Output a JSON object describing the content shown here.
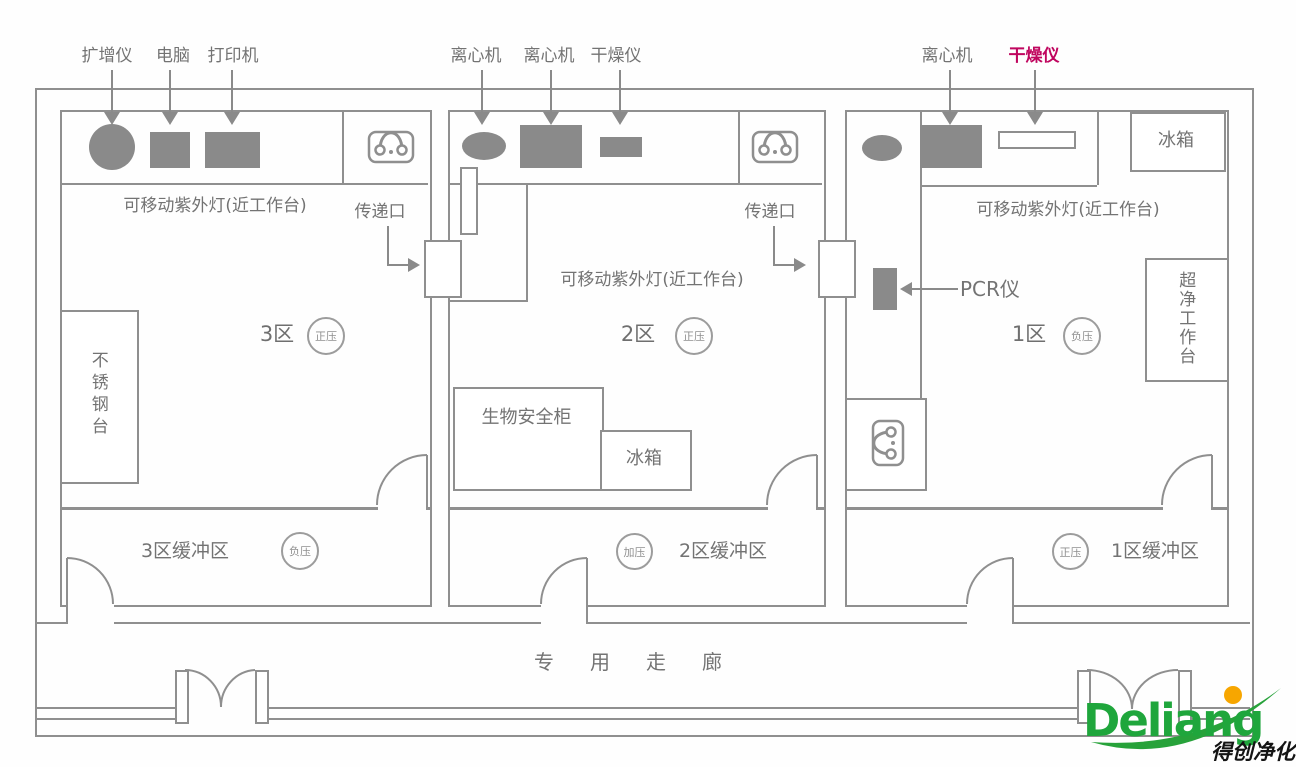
{
  "colors": {
    "wall_line": "#8f8f8f",
    "equipment_fill": "#8a8a8a",
    "label_text": "#737373",
    "highlight_label": "#c0065f",
    "logo_green": "#1fa63c",
    "logo_dot": "#f7a600",
    "logo_sub_text": "#141414"
  },
  "zone3": {
    "name": "3区",
    "pressure": "正压",
    "equipment": [
      "扩增仪",
      "电脑",
      "打印机"
    ],
    "uv_lamp": "可移动紫外灯(近工作台)",
    "steel_table": "不锈钢台",
    "pass_window": "传递口"
  },
  "zone2": {
    "name": "2区",
    "pressure": "正压",
    "equipment": [
      "离心机",
      "离心机",
      "干燥仪"
    ],
    "uv_lamp": "可移动紫外灯(近工作台)",
    "biosafety_cabinet": "生物安全柜",
    "fridge": "冰箱",
    "pass_window": "传递口"
  },
  "zone1": {
    "name": "1区",
    "pressure": "负压",
    "equipment": [
      "离心机",
      "干燥仪"
    ],
    "uv_lamp": "可移动紫外灯(近工作台)",
    "pcr": "PCR仪",
    "fridge": "冰箱",
    "clean_bench": "超净工作台"
  },
  "buffer3": {
    "label": "3区缓冲区",
    "pressure": "负压"
  },
  "buffer2": {
    "label": "2区缓冲区",
    "pressure": "加压"
  },
  "buffer1": {
    "label": "1区缓冲区",
    "pressure": "正压"
  },
  "corridor": {
    "label": "专用走廊"
  },
  "logo": {
    "brand": "Deliang",
    "subtitle": "得创净化"
  }
}
